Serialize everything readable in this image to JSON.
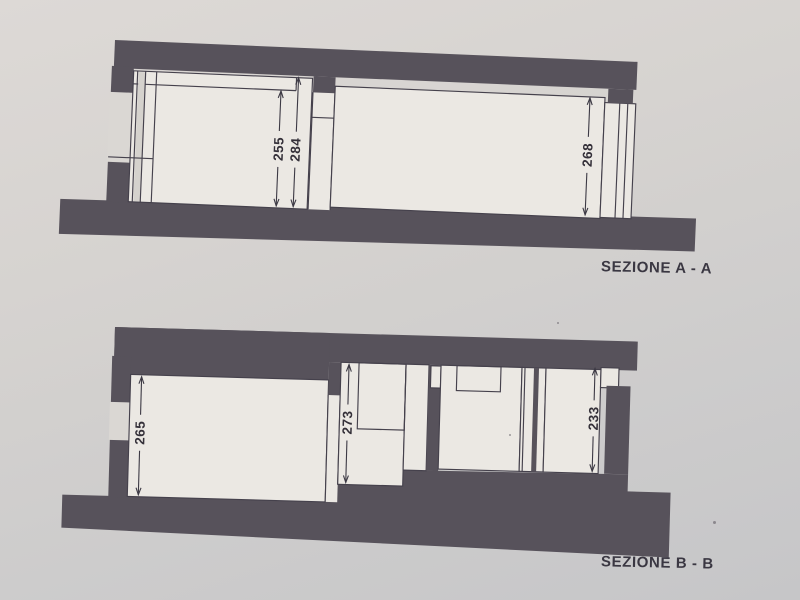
{
  "document_kind": "scanned architectural section drawing",
  "colors": {
    "paper_light": "#ddd9d6",
    "paper_dark": "#c6c6c8",
    "slab_dark": "#57525b",
    "line": "#45414c",
    "room_fill": "#ebe8e3",
    "text": "#3a3742"
  },
  "sections": [
    {
      "id": "section-a",
      "title": "SEZIONE A - A",
      "dims": [
        {
          "label": "255"
        },
        {
          "label": "284"
        },
        {
          "label": "268"
        }
      ]
    },
    {
      "id": "section-b",
      "title": "SEZIONE B - B",
      "dims": [
        {
          "label": "265"
        },
        {
          "label": "273"
        },
        {
          "label": "233"
        }
      ]
    }
  ]
}
